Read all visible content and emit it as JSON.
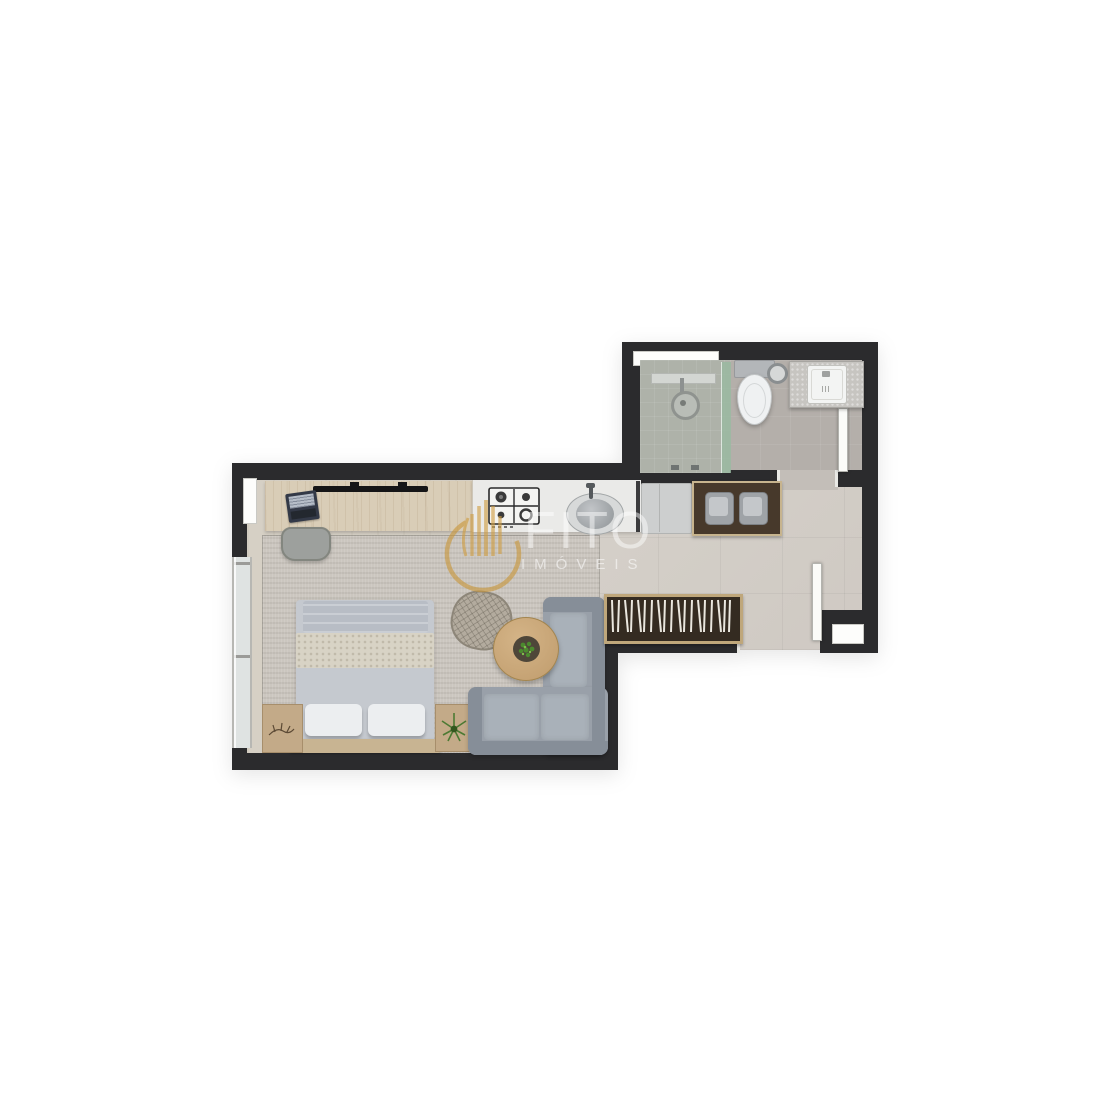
{
  "watermark": {
    "brand": "FITO",
    "subtitle": "IMÓVEIS",
    "logo_icon": "gold-ring-with-building-columns",
    "logo_color": "#c9973b"
  },
  "scene": {
    "type": "floor-plan",
    "unit": "studio-apartment",
    "rooms": [
      "living-bedroom",
      "kitchen",
      "entry-hall",
      "bathroom"
    ],
    "furniture": [
      "desk",
      "laptop",
      "tv-soundbar",
      "desk-chair",
      "cooktop",
      "kitchen-sink",
      "fridge",
      "console-table",
      "stool",
      "stool",
      "slatted-bench",
      "l-shaped-sofa",
      "coffee-table",
      "potted-plant",
      "lounge-chair",
      "double-bed",
      "pillows",
      "nightstand-left",
      "nightstand-right",
      "shower",
      "shower-drain",
      "toilet",
      "vanity-washbasin"
    ],
    "openings": [
      "bathroom-window",
      "bedroom-window-slot",
      "bedroom-glass-door",
      "bathroom-door",
      "entrance-door",
      "entrance-threshold"
    ]
  },
  "palette": {
    "background": "#ffffff",
    "walls": "#2b2b2d",
    "living_rug": "#cbc6bf",
    "wood_floor": "#d6d0c5",
    "hall_tile": "#d4cfc8",
    "bathroom_tile": "#b4afaa",
    "shower_glass": "#9cb8a3",
    "desk_wood": "#d9cdb7",
    "counter": "#e9e9e7",
    "console_wood": "#47392b",
    "sofa": "#99a0a9",
    "bed_linen": "#c6cad0",
    "blanket": "#d8d3c5",
    "accent_wood": "#c3a987",
    "plant_green": "#4c7a33",
    "fixture_white": "#eff1f2"
  }
}
